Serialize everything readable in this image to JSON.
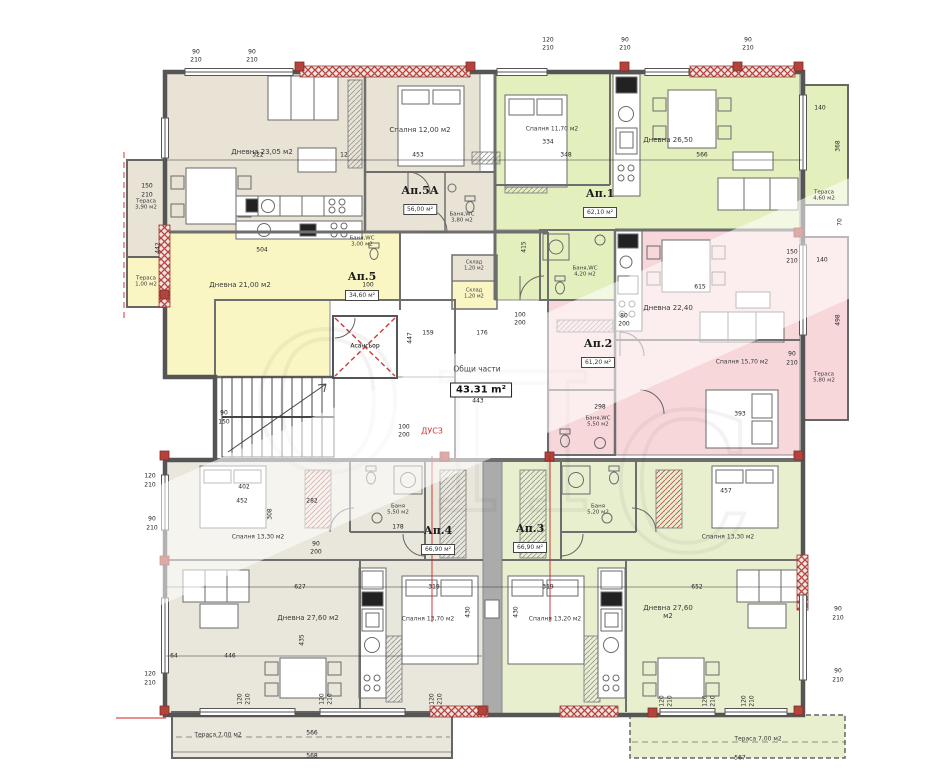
{
  "common": {
    "label": "Общи части",
    "area": "43.31 m²",
    "elevator": "Асансьор",
    "duct": "ДУСЗ"
  },
  "colors": {
    "beige": "#e8e3d4",
    "beige2": "#e9e6dc",
    "yellow": "#f9f6c3",
    "green": "#e4efbe",
    "green2": "#e7efcf",
    "pink": "#f8d7da",
    "wall_red": "#b5433c",
    "axis_red": "#cc2222",
    "wall_grey": "#555555"
  },
  "apartments": [
    {
      "name": "Ап.5А",
      "area": "56,00 м²",
      "x": 420,
      "y": 200
    },
    {
      "name": "Ап.5",
      "area": "34,60 м²",
      "x": 362,
      "y": 286
    },
    {
      "name": "Ап.1",
      "area": "62,10 м²",
      "x": 600,
      "y": 203
    },
    {
      "name": "Ап.2",
      "area": "61,20 м²",
      "x": 598,
      "y": 353
    },
    {
      "name": "Ап.4",
      "area": "66,90 м²",
      "x": 438,
      "y": 540
    },
    {
      "name": "Ап.3",
      "area": "66,90 м²",
      "x": 530,
      "y": 538
    }
  ],
  "room_labels": [
    {
      "t": "Дневна 23,05 м2",
      "x": 262,
      "y": 152
    },
    {
      "t": "Спалня 12,00 м2",
      "x": 420,
      "y": 130
    },
    {
      "t": "Баня,WC\n3,80 м2",
      "x": 462,
      "y": 218,
      "s": 5.5
    },
    {
      "t": "Тераса\n3,90 м2",
      "x": 146,
      "y": 205,
      "s": 5.5
    },
    {
      "t": "Дневна 21,00 м2",
      "x": 240,
      "y": 285
    },
    {
      "t": "Баня,WC\n3,00 м2",
      "x": 362,
      "y": 242,
      "s": 5.5
    },
    {
      "t": "Тераса\n1,00 м2",
      "x": 146,
      "y": 282,
      "s": 5.5
    },
    {
      "t": "Склад\n1,20 м2",
      "x": 474,
      "y": 266,
      "s": 5
    },
    {
      "t": "Склад\n1,20 м2",
      "x": 474,
      "y": 294,
      "s": 5
    },
    {
      "t": "Асансьор",
      "x": 365,
      "y": 347,
      "s": 6
    },
    {
      "t": "ДУСЗ",
      "x": 432,
      "y": 431,
      "s": 8,
      "c": "#cc3333"
    },
    {
      "t": "Спалня 11,70 м2",
      "x": 552,
      "y": 130,
      "s": 6
    },
    {
      "t": "Дневна 26,50",
      "x": 668,
      "y": 140
    },
    {
      "t": "Баня,WC\n4,20 м2",
      "x": 585,
      "y": 272,
      "s": 5.5
    },
    {
      "t": "Тераса\n4,60 м2",
      "x": 824,
      "y": 196,
      "s": 5.5
    },
    {
      "t": "Дневна 22,40",
      "x": 668,
      "y": 308
    },
    {
      "t": "Спалня 15,70 м2",
      "x": 742,
      "y": 363,
      "s": 6
    },
    {
      "t": "Баня,WC\n5,50 м2",
      "x": 598,
      "y": 422,
      "s": 5.5
    },
    {
      "t": "Тераса\n5,80 м2",
      "x": 824,
      "y": 378,
      "s": 5.5
    },
    {
      "t": "Спалня 13,30 м2",
      "x": 258,
      "y": 538,
      "s": 6
    },
    {
      "t": "Баня\n5,50 м2",
      "x": 398,
      "y": 510,
      "s": 5.5
    },
    {
      "t": "Дневна 27,60 м2",
      "x": 308,
      "y": 618
    },
    {
      "t": "Спалня 13,70 м2",
      "x": 428,
      "y": 620,
      "s": 6
    },
    {
      "t": "Тераса 7,00 м2",
      "x": 218,
      "y": 736,
      "s": 6
    },
    {
      "t": "Баня\n5,20 м2",
      "x": 598,
      "y": 510,
      "s": 5.5
    },
    {
      "t": "Спалня 13,30 м2",
      "x": 728,
      "y": 538,
      "s": 6
    },
    {
      "t": "Спалня 13,20 м2",
      "x": 555,
      "y": 620,
      "s": 6
    },
    {
      "t": "Дневна 27,60\nм2",
      "x": 668,
      "y": 612
    },
    {
      "t": "Тераса 7,00 м2",
      "x": 758,
      "y": 740,
      "s": 6
    }
  ],
  "dims": [
    {
      "t": "90",
      "x": 196,
      "y": 52
    },
    {
      "t": "210",
      "x": 196,
      "y": 60
    },
    {
      "t": "90",
      "x": 252,
      "y": 52
    },
    {
      "t": "210",
      "x": 252,
      "y": 60
    },
    {
      "t": "120",
      "x": 548,
      "y": 40
    },
    {
      "t": "210",
      "x": 548,
      "y": 48
    },
    {
      "t": "90",
      "x": 625,
      "y": 40
    },
    {
      "t": "210",
      "x": 625,
      "y": 48
    },
    {
      "t": "90",
      "x": 748,
      "y": 40
    },
    {
      "t": "210",
      "x": 748,
      "y": 48
    },
    {
      "t": "522",
      "x": 258,
      "y": 155
    },
    {
      "t": "12",
      "x": 344,
      "y": 155
    },
    {
      "t": "453",
      "x": 418,
      "y": 155
    },
    {
      "t": "334",
      "x": 548,
      "y": 142
    },
    {
      "t": "348",
      "x": 566,
      "y": 155
    },
    {
      "t": "566",
      "x": 702,
      "y": 155
    },
    {
      "t": "442",
      "x": 158,
      "y": 248,
      "r": 1
    },
    {
      "t": "504",
      "x": 262,
      "y": 250
    },
    {
      "t": "150",
      "x": 147,
      "y": 186
    },
    {
      "t": "210",
      "x": 147,
      "y": 195
    },
    {
      "t": "176",
      "x": 482,
      "y": 333
    },
    {
      "t": "159",
      "x": 428,
      "y": 333
    },
    {
      "t": "100",
      "x": 520,
      "y": 315
    },
    {
      "t": "200",
      "x": 520,
      "y": 323
    },
    {
      "t": "443",
      "x": 478,
      "y": 401
    },
    {
      "t": "447",
      "x": 410,
      "y": 338,
      "r": 1
    },
    {
      "t": "415",
      "x": 524,
      "y": 247,
      "r": 1
    },
    {
      "t": "100",
      "x": 368,
      "y": 285
    },
    {
      "t": "200",
      "x": 368,
      "y": 293
    },
    {
      "t": "100",
      "x": 404,
      "y": 427
    },
    {
      "t": "200",
      "x": 404,
      "y": 435
    },
    {
      "t": "90",
      "x": 224,
      "y": 413
    },
    {
      "t": "150",
      "x": 224,
      "y": 422
    },
    {
      "t": "140",
      "x": 820,
      "y": 108
    },
    {
      "t": "368",
      "x": 838,
      "y": 146,
      "r": 1
    },
    {
      "t": "70",
      "x": 840,
      "y": 222,
      "r": 1
    },
    {
      "t": "150",
      "x": 792,
      "y": 252
    },
    {
      "t": "210",
      "x": 792,
      "y": 261
    },
    {
      "t": "90",
      "x": 792,
      "y": 354
    },
    {
      "t": "210",
      "x": 792,
      "y": 363
    },
    {
      "t": "140",
      "x": 822,
      "y": 260
    },
    {
      "t": "498",
      "x": 838,
      "y": 320,
      "r": 1
    },
    {
      "t": "615",
      "x": 700,
      "y": 287
    },
    {
      "t": "298",
      "x": 600,
      "y": 407
    },
    {
      "t": "80",
      "x": 624,
      "y": 316
    },
    {
      "t": "200",
      "x": 624,
      "y": 324
    },
    {
      "t": "393",
      "x": 740,
      "y": 414
    },
    {
      "t": "402",
      "x": 244,
      "y": 487
    },
    {
      "t": "452",
      "x": 242,
      "y": 501
    },
    {
      "t": "282",
      "x": 312,
      "y": 501
    },
    {
      "t": "178",
      "x": 398,
      "y": 527
    },
    {
      "t": "308",
      "x": 270,
      "y": 514,
      "r": 1
    },
    {
      "t": "90",
      "x": 316,
      "y": 544
    },
    {
      "t": "200",
      "x": 316,
      "y": 552
    },
    {
      "t": "627",
      "x": 300,
      "y": 587
    },
    {
      "t": "319",
      "x": 434,
      "y": 587
    },
    {
      "t": "319",
      "x": 548,
      "y": 587
    },
    {
      "t": "652",
      "x": 697,
      "y": 587
    },
    {
      "t": "457",
      "x": 726,
      "y": 491
    },
    {
      "t": "446",
      "x": 230,
      "y": 656
    },
    {
      "t": "64",
      "x": 174,
      "y": 656
    },
    {
      "t": "435",
      "x": 302,
      "y": 640,
      "r": 1
    },
    {
      "t": "430",
      "x": 468,
      "y": 612,
      "r": 1
    },
    {
      "t": "430",
      "x": 516,
      "y": 612,
      "r": 1
    },
    {
      "t": "90",
      "x": 838,
      "y": 609
    },
    {
      "t": "210",
      "x": 838,
      "y": 618
    },
    {
      "t": "90",
      "x": 838,
      "y": 671
    },
    {
      "t": "210",
      "x": 838,
      "y": 680
    },
    {
      "t": "120",
      "x": 150,
      "y": 476
    },
    {
      "t": "210",
      "x": 150,
      "y": 485
    },
    {
      "t": "90",
      "x": 152,
      "y": 519
    },
    {
      "t": "210",
      "x": 152,
      "y": 528
    },
    {
      "t": "120",
      "x": 150,
      "y": 674
    },
    {
      "t": "210",
      "x": 150,
      "y": 683
    },
    {
      "t": "120",
      "x": 240,
      "y": 699,
      "r": 1
    },
    {
      "t": "210",
      "x": 248,
      "y": 699,
      "r": 1
    },
    {
      "t": "120",
      "x": 322,
      "y": 699,
      "r": 1
    },
    {
      "t": "210",
      "x": 330,
      "y": 699,
      "r": 1
    },
    {
      "t": "120",
      "x": 432,
      "y": 699,
      "r": 1
    },
    {
      "t": "210",
      "x": 440,
      "y": 699,
      "r": 1
    },
    {
      "t": "566",
      "x": 312,
      "y": 733
    },
    {
      "t": "568",
      "x": 312,
      "y": 756
    },
    {
      "t": "120",
      "x": 662,
      "y": 701,
      "r": 1
    },
    {
      "t": "210",
      "x": 670,
      "y": 701,
      "r": 1
    },
    {
      "t": "120",
      "x": 705,
      "y": 701,
      "r": 1
    },
    {
      "t": "210",
      "x": 713,
      "y": 701,
      "r": 1
    },
    {
      "t": "120",
      "x": 744,
      "y": 701,
      "r": 1
    },
    {
      "t": "210",
      "x": 752,
      "y": 701,
      "r": 1
    },
    {
      "t": "567",
      "x": 740,
      "y": 758
    }
  ]
}
